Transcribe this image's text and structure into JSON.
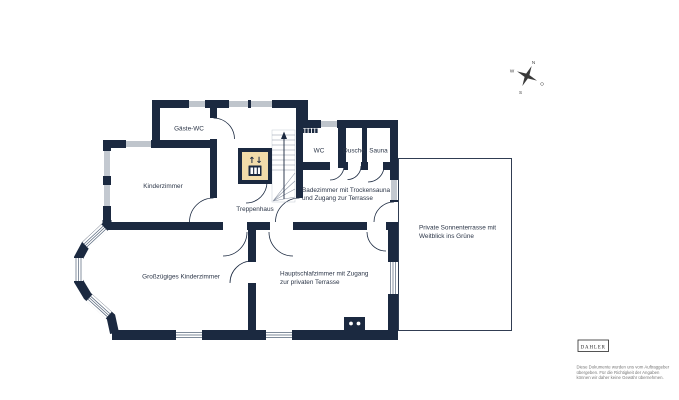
{
  "page": {
    "background": "#ffffff"
  },
  "plan": {
    "colors": {
      "wall": "#1b2940",
      "window_line": "#55657a",
      "stair_line": "#8a93a3",
      "label_text": "#2b3547",
      "elevator_fill": "#f2dcaa",
      "disclaimer_text": "#777777"
    },
    "rooms": [
      {
        "id": "gaeste_wc",
        "label": "Gäste-WC"
      },
      {
        "id": "kinderzimmer",
        "label": "Kinderzimmer"
      },
      {
        "id": "treppenhaus",
        "label": "Treppenhaus"
      },
      {
        "id": "wc",
        "label": "WC"
      },
      {
        "id": "dusche",
        "label": "Dusche"
      },
      {
        "id": "sauna",
        "label": "Sauna"
      },
      {
        "id": "badezimmer",
        "label_line1": "Badezimmer mit Trockensauna",
        "label_line2": "und Zugang zur Terrasse"
      },
      {
        "id": "grosszuegiges_kinderzimmer",
        "label": "Großzügiges Kinderzimmer"
      },
      {
        "id": "hauptschlafzimmer",
        "label_line1": "Hauptschlafzimmer mit Zugang",
        "label_line2": "zur privaten Terrasse"
      },
      {
        "id": "sonnenterrasse",
        "label_line1": "Private Sonnenterrasse mit",
        "label_line2": "Weitblick ins Grüne"
      }
    ],
    "elevator": {
      "arrows": "↑↓"
    },
    "compass": {
      "n": "N",
      "e": "O",
      "s": "S",
      "w": "W"
    }
  },
  "branding": {
    "logo_text": "DAHLER",
    "disclaimer_line1": "Diese Dokumente wurden uns vom Auftraggeber",
    "disclaimer_line2": "übergeben. Für die Richtigkeit der Angaben",
    "disclaimer_line3": "können wir daher keine Gewähr übernehmen."
  }
}
